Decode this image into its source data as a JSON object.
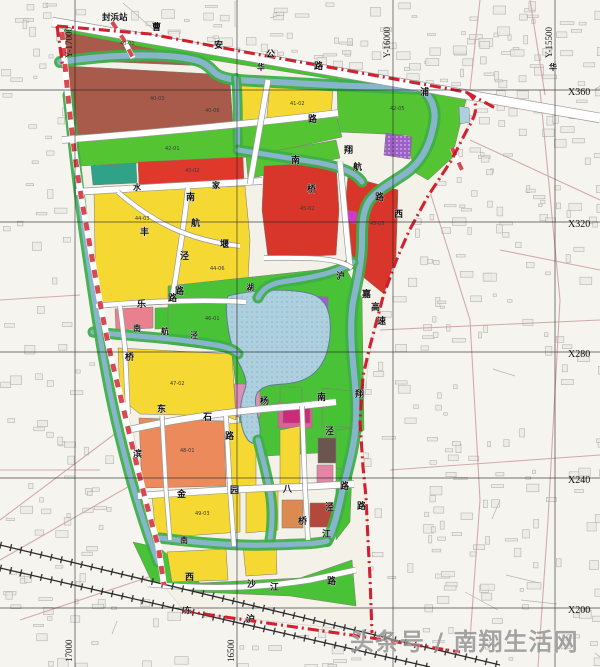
{
  "canvas": {
    "w": 600,
    "h": 667,
    "bg": "#f6f4ef"
  },
  "station": {
    "label": "封浜站"
  },
  "watermark": {
    "text": "头条号 / 南翔生活网",
    "x": 350,
    "y": 650,
    "size": 24,
    "color": "#8f8f8f"
  },
  "colors": {
    "boundary": "#cf1020",
    "stripe": "#d3343f",
    "water": "#aed0de",
    "waterEdge": "#3f85ad",
    "bank": "#3fae4a",
    "roadFill": "#ffffff",
    "roadEdge": "#9a9a9a",
    "grid": "#1c1c1c",
    "rail": "#2b2b2b",
    "texture": "#a7a5a0",
    "outsideRoad": "#c99a9a"
  },
  "grid": {
    "verticals": [
      {
        "x": 75,
        "top_label": "Y-17000",
        "bottom_label": "17000"
      },
      {
        "x": 237,
        "top_label": "",
        "bottom_label": "16500"
      },
      {
        "x": 393,
        "top_label": "Y-16000",
        "bottom_label": ""
      },
      {
        "x": 555,
        "top_label": "Y-15500",
        "bottom_label": ""
      }
    ],
    "horizontals": [
      {
        "y": 90,
        "label": "X360"
      },
      {
        "y": 222,
        "label": "X320"
      },
      {
        "y": 352,
        "label": "X280"
      },
      {
        "y": 478,
        "label": "X240"
      },
      {
        "y": 608,
        "label": "X200"
      }
    ]
  },
  "site_base": {
    "points": "57,26 150,35 250,54 350,72 466,92 468,128 452,160 430,195 410,230 397,260 384,296 371,345 361,420 366,495 370,577 372,632 185,612 163,585 145,485 133,432 117,382 100,290 85,218 78,160 70,100 62,32",
    "fill": "#f3f1e8"
  },
  "parcels": [
    {
      "name": "residential-brown-upper",
      "points": "64,26 204,56 208,66 66,60",
      "fill": "#a85b4a"
    },
    {
      "name": "residential-brown-main",
      "points": "66,66 212,74 230,80 233,127 180,131 70,135",
      "fill": "#a85b4a"
    },
    {
      "name": "residential-yellow-ne-1",
      "points": "237,77 264,80 262,128 240,128",
      "fill": "#f5d832"
    },
    {
      "name": "residential-yellow-ne-2",
      "points": "270,81 333,88 330,130 266,128",
      "fill": "#f5d832"
    },
    {
      "name": "green-strip-top",
      "points": "68,22 464,90 458,99 212,60 64,32",
      "fill": "#47c235"
    },
    {
      "name": "green-wedge-ne",
      "points": "337,72 460,93 466,100 452,158 428,180 414,172 407,135 338,132",
      "fill": "#55c433"
    },
    {
      "name": "special-purple-hatch",
      "points": "386,133 412,137 410,159 384,155",
      "fill": "#9e5fc9",
      "hatch": true
    },
    {
      "name": "green-band-2",
      "points": "72,138 336,115 342,137 250,157 80,166",
      "fill": "#55c433"
    },
    {
      "name": "school-teal",
      "points": "91,166 136,163 137,183 93,185",
      "fill": "#2fa287"
    },
    {
      "name": "commercial-red-band",
      "points": "138,162 243,157 244,183 139,185",
      "fill": "#e0392c"
    },
    {
      "name": "green-band-2e",
      "points": "246,156 336,140 340,158 248,179",
      "fill": "#55c433"
    },
    {
      "name": "residential-yellow-main",
      "points": "94,192 188,188 245,186 250,240 247,300 170,304 96,308",
      "fill": "#f5d832"
    },
    {
      "name": "commercial-red-a",
      "points": "264,166 336,162 339,210 336,255 268,258 262,210",
      "fill": "#d8352b"
    },
    {
      "name": "commercial-red-b",
      "points": "348,176 398,190 396,256 384,294 352,268 344,216",
      "fill": "#d8352b"
    },
    {
      "name": "utility-magenta-small",
      "points": "345,210 357,212 356,224 344,222",
      "fill": "#d437c9"
    },
    {
      "name": "mixed-pink-row-1",
      "points": "115,309 153,307 153,328 116,330",
      "fill": "#e8808e"
    },
    {
      "name": "green-row",
      "points": "155,308 186,307 186,328 155,329",
      "fill": "#47c235"
    },
    {
      "name": "mixed-pink-row-2",
      "points": "188,308 235,307 236,330 188,331",
      "fill": "#eea2aa"
    },
    {
      "name": "park-central",
      "points": "168,286 345,267 362,298 364,430 334,452 266,456 240,426 232,352 168,344",
      "fill": "#49c238"
    },
    {
      "name": "park-pink-1",
      "points": "234,384 260,384 260,417 236,417",
      "fill": "#e08fb4"
    },
    {
      "name": "park-pink-2",
      "points": "278,402 312,403 312,428 278,428",
      "fill": "#d8649a"
    },
    {
      "name": "park-purple",
      "points": "312,296 328,297 328,315 312,314",
      "fill": "#9e5fc9"
    },
    {
      "name": "residential-yellow-sw",
      "points": "118,348 232,354 236,420 226,416 140,414 120,398",
      "fill": "#f5d832"
    },
    {
      "name": "commercial-orange",
      "points": "139,418 224,421 226,486 142,488",
      "fill": "#ec8a5c"
    },
    {
      "name": "residential-yellow-mid-s1",
      "points": "228,424 256,421 256,487 230,488",
      "fill": "#f5d832"
    },
    {
      "name": "residential-yellow-mid-s2",
      "points": "280,430 300,426 300,486 280,487",
      "fill": "#f5d832"
    },
    {
      "name": "green-br-1",
      "points": "280,387 302,387 302,403 280,403",
      "fill": "#47c235"
    },
    {
      "name": "green-br-2",
      "points": "322,388 352,391 352,427 322,427",
      "fill": "#47c235"
    },
    {
      "name": "magenta-br",
      "points": "283,405 310,405 310,423 283,423",
      "fill": "#cf2a7a"
    },
    {
      "name": "industrial-dark-br",
      "points": "318,438 336,438 336,463 318,463",
      "fill": "#6a564f"
    },
    {
      "name": "pink-br",
      "points": "317,465 333,465 333,483 317,483",
      "fill": "#e585a6"
    },
    {
      "name": "redbrown-br",
      "points": "310,503 333,503 333,527 310,527",
      "fill": "#b5483c"
    },
    {
      "name": "orange-br",
      "points": "282,500 303,500 303,528 282,528",
      "fill": "#dc8a50"
    },
    {
      "name": "green-br-3",
      "points": "336,468 352,470 350,522 336,540",
      "fill": "#47c235"
    },
    {
      "name": "green-east-corr",
      "points": "336,430 354,428 352,470 336,468",
      "fill": "#49c238"
    },
    {
      "name": "green-south-wedge",
      "points": "133,542 160,548 200,583 300,578 352,560 356,606 290,596 195,592 152,582",
      "fill": "#49c238"
    },
    {
      "name": "residential-yellow-s1",
      "points": "152,495 240,492 240,532 156,538",
      "fill": "#f5d832"
    },
    {
      "name": "residential-yellow-s2",
      "points": "246,492 278,491 278,530 246,533",
      "fill": "#f5d832"
    },
    {
      "name": "residential-yellow-s3",
      "points": "167,552 226,549 228,580 172,582",
      "fill": "#f5d832"
    },
    {
      "name": "residential-yellow-s4",
      "points": "243,546 276,544 277,574 246,576",
      "fill": "#f5d832"
    },
    {
      "name": "pond-ne",
      "points": "459,106 469,108 470,122 460,124",
      "fill": "#aed0de"
    }
  ],
  "lake": {
    "path": "M228,296 C250,290 285,288 308,293 C326,297 332,312 330,335 C328,360 318,375 300,381 C282,387 268,381 258,392 C252,400 258,412 260,428 C261,440 255,448 248,440 C240,430 238,408 244,392 C250,378 240,368 234,352 C228,336 224,305 228,296 Z"
  },
  "rivers": [
    {
      "name": "north-canal",
      "d": "M60,62 C110,54 160,54 185,58 C205,61 208,66 215,73 C222,79 235,80 255,81 L330,85 L422,89",
      "w": 6
    },
    {
      "name": "east-river",
      "d": "M422,89 C434,100 437,113 433,128 C429,148 420,163 406,173 C390,184 374,192 368,203 C362,214 362,228 362,242 C362,262 357,282 353,302 C350,322 351,342 353,362 C355,385 357,400 356,420 C355,445 348,468 342,492 C338,512 334,528 327,541",
      "w": 6
    },
    {
      "name": "mid-river-feeder",
      "d": "M236,78 C239,102 237,126 238,150",
      "w": 4
    },
    {
      "name": "mid-river",
      "d": "M238,150 C258,153 290,158 320,163 C340,167 355,172 362,182",
      "w": 5
    },
    {
      "name": "mid-river-return",
      "d": "M353,262 C340,272 310,278 288,281 C270,283 262,289 258,298",
      "w": 5
    },
    {
      "name": "sw-canal",
      "d": "M93,332 C130,336 175,338 215,345 C228,347 234,350 238,354",
      "w": 5
    },
    {
      "name": "lake-outlet",
      "d": "M258,440 C263,460 268,478 271,498 C273,515 272,528 270,540",
      "w": 5
    },
    {
      "name": "bottom-river",
      "d": "M160,538 C200,543 240,546 270,545 C300,544 318,544 327,541",
      "w": 5
    },
    {
      "name": "west-canal",
      "d": "M68,95 C74,150 80,205 88,258 C96,312 104,368 116,420 C128,472 142,520 158,562",
      "w": 5
    }
  ],
  "roads": [
    {
      "name": "caoan-highway",
      "d": "M52,22 L600,118",
      "w": 9
    },
    {
      "name": "road-huapu",
      "d": "M62,140 C150,133 250,124 338,113",
      "w": 6
    },
    {
      "name": "road-zhujia",
      "d": "M76,192 C150,187 220,184 262,181",
      "w": 6
    },
    {
      "name": "road-vert-ne",
      "d": "M268,80 C263,110 257,145 250,184",
      "w": 5
    },
    {
      "name": "road-nanhangjing",
      "d": "M188,188 C184,225 179,258 172,300",
      "w": 4.5
    },
    {
      "name": "road-diag-nw",
      "d": "M118,192 C150,220 185,240 240,246",
      "w": 4
    },
    {
      "name": "road-le",
      "d": "M96,306 C160,300 215,300 246,302",
      "w": 4.5
    },
    {
      "name": "road-bridge-east",
      "d": "M340,162 C343,190 346,230 350,266",
      "w": 5
    },
    {
      "name": "road-south-reda",
      "d": "M264,258 C300,258 336,256 352,268",
      "w": 4
    },
    {
      "name": "road-dongshi",
      "d": "M128,430 C180,418 240,410 300,406 L336,402",
      "w": 6
    },
    {
      "name": "road-jinyuan",
      "d": "M138,496 C200,491 260,488 300,487 L354,484",
      "w": 6
    },
    {
      "name": "road-vert-228",
      "d": "M226,416 L230,490 L234,546",
      "w": 4
    },
    {
      "name": "road-vert-305",
      "d": "M302,406 L305,487 L308,540",
      "w": 4
    },
    {
      "name": "road-xishajiang",
      "d": "M148,584 C210,590 260,588 310,580 L356,570",
      "w": 5
    },
    {
      "name": "road-vert-165",
      "d": "M162,416 L166,490 L170,540",
      "w": 3.5
    },
    {
      "name": "road-vert-qiao",
      "d": "M120,306 L125,348 L128,414",
      "w": 4
    }
  ],
  "outside_roads": [
    "M540,90 L560,300 L548,520 L538,667",
    "M420,160 L470,320 L480,500 L470,640",
    "M380,330 L600,320",
    "M390,470 L600,455",
    "M480,0 L470,90",
    "M530,0 L545,95",
    "M0,300 L80,295",
    "M0,470 L100,470",
    "M0,520 L120,430",
    "M0,560 L140,480",
    "M20,620 L200,560",
    "M470,140 L600,200",
    "M500,250 L600,270"
  ],
  "railways": [
    {
      "name": "hu-ning-railway",
      "d": "M0,545 L500,665"
    },
    {
      "name": "railway-branch",
      "d": "M0,568 L430,667"
    }
  ],
  "boundary": {
    "segments": [
      "M57,26 L150,34 L250,53 L350,71 L466,92",
      "M466,92 C480,101 477,114 468,128 L451,161 L428,196 L409,231 L396,261 L383,297 L370,346 L363,376 L360,422 L363,467 L366,497 L368,540 L370,578 L372,633",
      "M183,611 L372,638 L460,652",
      "M466,92 L497,109",
      "M57,26 L63,68"
    ],
    "stripe_band": "M62,32 C68,100 74,160 85,218 C96,280 104,330 117,382 C130,435 143,495 158,545 L164,585",
    "stripe_spur": "M112,22 L124,40 L133,58",
    "stripe_ne": "M452,148 L462,170"
  },
  "labels": [
    {
      "t": "曹",
      "x": 152,
      "y": 30
    },
    {
      "t": "安",
      "x": 214,
      "y": 48
    },
    {
      "t": "公",
      "x": 266,
      "y": 57
    },
    {
      "t": "路",
      "x": 314,
      "y": 69
    },
    {
      "t": "华",
      "x": 549,
      "y": 70,
      "s": 8
    },
    {
      "t": "华",
      "x": 257,
      "y": 70,
      "s": 8
    },
    {
      "t": "浦",
      "x": 420,
      "y": 95
    },
    {
      "t": "路",
      "x": 308,
      "y": 122
    },
    {
      "t": "翔",
      "x": 344,
      "y": 153
    },
    {
      "t": "南",
      "x": 291,
      "y": 163
    },
    {
      "t": "航",
      "x": 353,
      "y": 170
    },
    {
      "t": "桥",
      "x": 307,
      "y": 192
    },
    {
      "t": "路",
      "x": 375,
      "y": 200
    },
    {
      "t": "西",
      "x": 394,
      "y": 217
    },
    {
      "t": "沪",
      "x": 336,
      "y": 279
    },
    {
      "t": "嘉",
      "x": 362,
      "y": 297
    },
    {
      "t": "高",
      "x": 371,
      "y": 310
    },
    {
      "t": "速",
      "x": 377,
      "y": 324
    },
    {
      "t": "家",
      "x": 212,
      "y": 188,
      "s": 8
    },
    {
      "t": "水",
      "x": 133,
      "y": 190,
      "s": 8
    },
    {
      "t": "南",
      "x": 186,
      "y": 200
    },
    {
      "t": "航",
      "x": 191,
      "y": 226
    },
    {
      "t": "泾",
      "x": 180,
      "y": 259
    },
    {
      "t": "路",
      "x": 175,
      "y": 294
    },
    {
      "t": "丰",
      "x": 140,
      "y": 235
    },
    {
      "t": "堰",
      "x": 220,
      "y": 247
    },
    {
      "t": "乐",
      "x": 137,
      "y": 307
    },
    {
      "t": "路",
      "x": 168,
      "y": 301
    },
    {
      "t": "南",
      "x": 133,
      "y": 331,
      "s": 8
    },
    {
      "t": "航",
      "x": 161,
      "y": 334,
      "s": 8
    },
    {
      "t": "泾",
      "x": 190,
      "y": 338,
      "s": 8
    },
    {
      "t": "桥",
      "x": 125,
      "y": 360
    },
    {
      "t": "湖",
      "x": 246,
      "y": 290,
      "s": 8
    },
    {
      "t": "杨",
      "x": 260,
      "y": 404
    },
    {
      "t": "南",
      "x": 317,
      "y": 400
    },
    {
      "t": "翔",
      "x": 355,
      "y": 397
    },
    {
      "t": "泾",
      "x": 325,
      "y": 434
    },
    {
      "t": "东",
      "x": 157,
      "y": 412
    },
    {
      "t": "石",
      "x": 203,
      "y": 420
    },
    {
      "t": "路",
      "x": 225,
      "y": 439
    },
    {
      "t": "滨",
      "x": 133,
      "y": 457
    },
    {
      "t": "金",
      "x": 177,
      "y": 497
    },
    {
      "t": "园",
      "x": 230,
      "y": 493
    },
    {
      "t": "八",
      "x": 283,
      "y": 492
    },
    {
      "t": "路",
      "x": 340,
      "y": 489
    },
    {
      "t": "泾",
      "x": 325,
      "y": 510
    },
    {
      "t": "路",
      "x": 357,
      "y": 509
    },
    {
      "t": "桥",
      "x": 298,
      "y": 524
    },
    {
      "t": "江",
      "x": 322,
      "y": 537
    },
    {
      "t": "南",
      "x": 180,
      "y": 543,
      "s": 8
    },
    {
      "t": "西",
      "x": 185,
      "y": 580
    },
    {
      "t": "沙",
      "x": 247,
      "y": 587
    },
    {
      "t": "江",
      "x": 270,
      "y": 590
    },
    {
      "t": "路",
      "x": 327,
      "y": 584
    },
    {
      "t": "东",
      "x": 184,
      "y": 613,
      "s": 8
    },
    {
      "t": "沪",
      "x": 246,
      "y": 622
    }
  ],
  "parcel_codes": [
    {
      "t": "40-01",
      "x": 120,
      "y": 45
    },
    {
      "t": "40-03",
      "x": 150,
      "y": 100
    },
    {
      "t": "40-06",
      "x": 205,
      "y": 112
    },
    {
      "t": "41-02",
      "x": 290,
      "y": 105
    },
    {
      "t": "42-05",
      "x": 390,
      "y": 110
    },
    {
      "t": "42-01",
      "x": 165,
      "y": 150
    },
    {
      "t": "43-02",
      "x": 185,
      "y": 172
    },
    {
      "t": "44-03",
      "x": 135,
      "y": 220
    },
    {
      "t": "44-06",
      "x": 210,
      "y": 270
    },
    {
      "t": "45-02",
      "x": 300,
      "y": 210
    },
    {
      "t": "45-05",
      "x": 370,
      "y": 225
    },
    {
      "t": "46-01",
      "x": 205,
      "y": 320
    },
    {
      "t": "47-02",
      "x": 170,
      "y": 385
    },
    {
      "t": "48-01",
      "x": 180,
      "y": 452
    },
    {
      "t": "49-03",
      "x": 195,
      "y": 515
    }
  ]
}
